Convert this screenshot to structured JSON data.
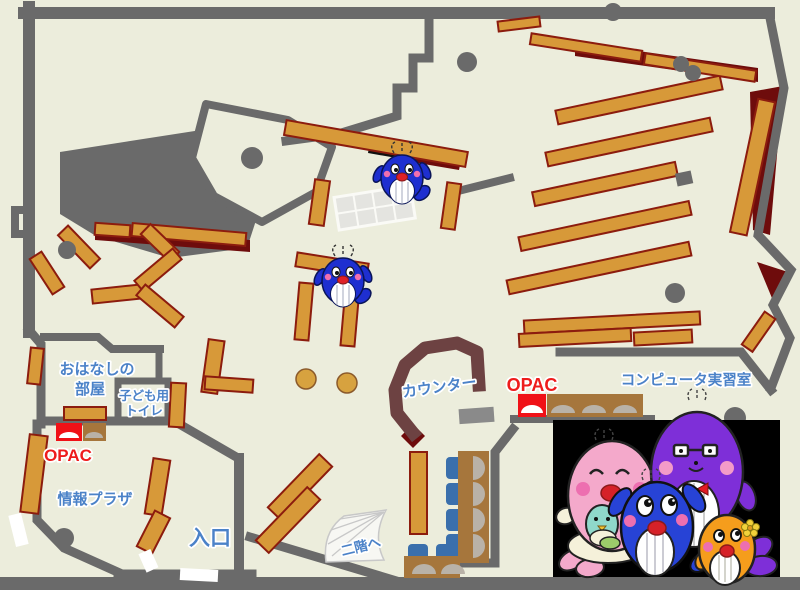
{
  "labels": {
    "storytelling_room_line1": "おはなしの",
    "storytelling_room_line2": "部屋",
    "kids_toilet_line1": "子ども用",
    "kids_toilet_line2": "トイレ",
    "opac_left": "OPAC",
    "opac_right": "OPAC",
    "info_plaza": "情報プラザ",
    "entrance": "入口",
    "counter": "カウンター",
    "computer_room": "コンピュータ実習室",
    "to_second_floor": "二階へ"
  },
  "colors": {
    "floor": "#ECEDDC",
    "wall_gray": "#6A6A6A",
    "bookshelf": "#D79939",
    "bookshelf_border": "#8C1C0E",
    "restricted_maroon": "#6E0C0C",
    "counter_brown": "#6D4242",
    "label_blue": "#4B82C8",
    "label_red": "#EE1C1C",
    "opac_red": "#F01117",
    "desk_brown": "#A6763C",
    "chair_blue": "#3A6FAC",
    "monitor_gray": "#B9B2A8",
    "whale_blue": "#1E2FD0",
    "photo_background": "#000000",
    "mother_pink": "#F4A9CB",
    "father_purple": "#7E2FD8",
    "child_orange": "#F59D1C",
    "baby_teal": "#8FD8CA"
  },
  "mascots": {
    "on_map": [
      "blue-whale",
      "blue-whale"
    ],
    "photo_family": [
      "pink-mother-whale",
      "purple-father-whale",
      "blue-child-whale",
      "orange-child-whale"
    ]
  }
}
